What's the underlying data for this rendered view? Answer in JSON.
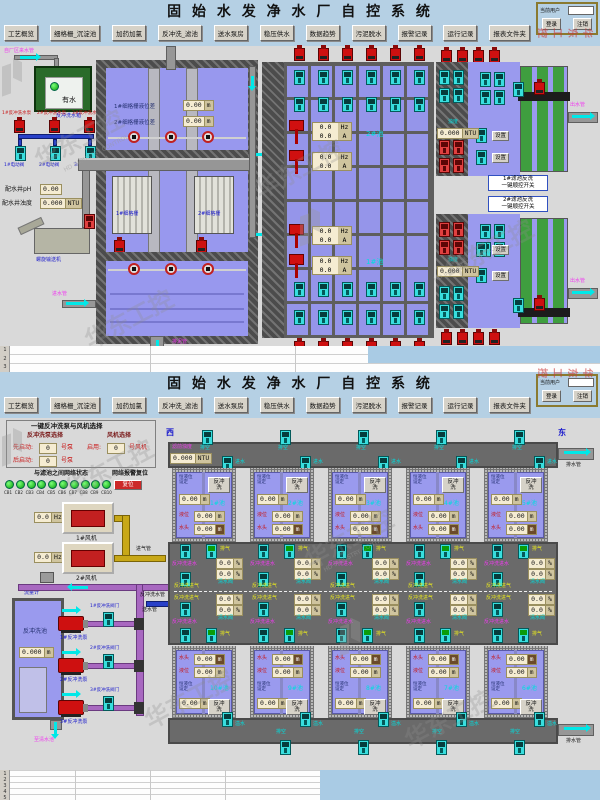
{
  "watermark": {
    "cn": "华东工控",
    "en": "HD INDUSTRY CONTROL"
  },
  "header": {
    "title": "固 始 水 发 净 水 厂 自 控 系 统",
    "nav": [
      "工艺概览",
      "细格栅_沉淀池",
      "加药加氯",
      "反冲洗_滤池",
      "送水泵房",
      "稳压供水",
      "数据趋势",
      "污泥脱水",
      "报警记录",
      "运行记录",
      "报表文件夹"
    ],
    "user_label": "当前用户",
    "login": "登录",
    "logout": "注销"
  },
  "s1": {
    "inlet_top": "自厂区来水管",
    "tank_ok": "有水",
    "tank_name": "反冲洗水箱",
    "pump_labels": [
      "1#反冲洗水泵",
      "2#反冲洗水泵",
      "3#反冲洗水泵"
    ],
    "valve_labels": [
      "1#电动阀",
      "2#电动阀",
      "3#电动阀"
    ],
    "ph_label": "配水井pH",
    "ph_value": "0.00",
    "ntu_label": "配水井浊度",
    "ntu_value": "0.000",
    "ntu_unit": "NTU",
    "screw": "螺旋输送机",
    "inlet_bottom": "进水管",
    "lvl1_label": "1#细格栅液位差",
    "lvl2_label": "2#细格栅液位差",
    "lvl_value": "0.00",
    "m_unit": "m",
    "screens": [
      "1#细格栅",
      "2#细格栅"
    ],
    "mud": "排泥管",
    "hz_value": "0.0",
    "hz_unit": "Hz",
    "a_value": "0.0",
    "a_unit": "A",
    "pool1": "1#池",
    "pool2": "2#池",
    "f_ntu_label": "浊度",
    "f_ntu_value": "0.000",
    "set_btn": "设置",
    "outlet": "出水管",
    "seq1a": "1#滤池反洗",
    "seq2a": "2#滤池反洗",
    "seq_b": "一键顺控开关"
  },
  "s2": {
    "west": "西",
    "east": "东",
    "panel": {
      "title": "一键反冲洗泵与风机选择",
      "pump_sel": "反冲洗泵选择",
      "fan_sel": "风机选择",
      "first": "先启动:",
      "last": "后启动:",
      "enable": "启用:",
      "pump_no": "号泵",
      "fan_no": "号风机",
      "num": "0",
      "net_title": "与滤池之间网络状态",
      "alarm": "网络报警复位",
      "reset": "复位",
      "cb": [
        "CB1",
        "CB2",
        "CB3",
        "CB4",
        "CB5",
        "CB6",
        "CB7",
        "CB8",
        "CB9",
        "CB10"
      ]
    },
    "fan1": "1#风机",
    "fan2": "2#风机",
    "fan_hz": "0.0",
    "hz_unit": "Hz",
    "flow": "流量计",
    "pipe_air": "进气管",
    "pipe_bw": "反冲洗水管",
    "pipe_send": "送水管",
    "bw_tank": "反冲洗池",
    "bw_level": "0.000",
    "m_unit": "m",
    "bw_pumps": [
      "1#反冲洗泵",
      "2#反冲洗泵",
      "3#反冲洗泵"
    ],
    "bw_valves": [
      "1#反冲洗阀门",
      "2#反冲洗阀门",
      "3#反冲洗阀门"
    ],
    "to_clean": "至清水池",
    "turb_label": "滤前浊度",
    "turb_value": "0.000",
    "turb_unit": "NTU",
    "drain": "排水管",
    "v_empty": "排空",
    "v_in": "进水",
    "v_over": "溢水",
    "cell": {
      "set1": "恒液位",
      "set2": "设定",
      "bw": "反冲洗",
      "lvl": "液位",
      "head": "水头",
      "v": "0.00",
      "pct": "0.0",
      "pct_u": "%"
    },
    "top_nums": [
      "1#池",
      "2#池",
      "3#池",
      "4#池",
      "5#池"
    ],
    "bot_nums": [
      "10#池",
      "9#池",
      "8#池",
      "7#池",
      "6#池"
    ],
    "cor": {
      "bw_water": "反冲洗进水",
      "vent": "排气",
      "bw_air": "反冲洗进气",
      "clean": "清水阀"
    }
  },
  "sheet": {
    "top": [
      "1",
      "2",
      "3"
    ],
    "bottom": [
      "1",
      "2",
      "3",
      "4",
      "5"
    ]
  }
}
